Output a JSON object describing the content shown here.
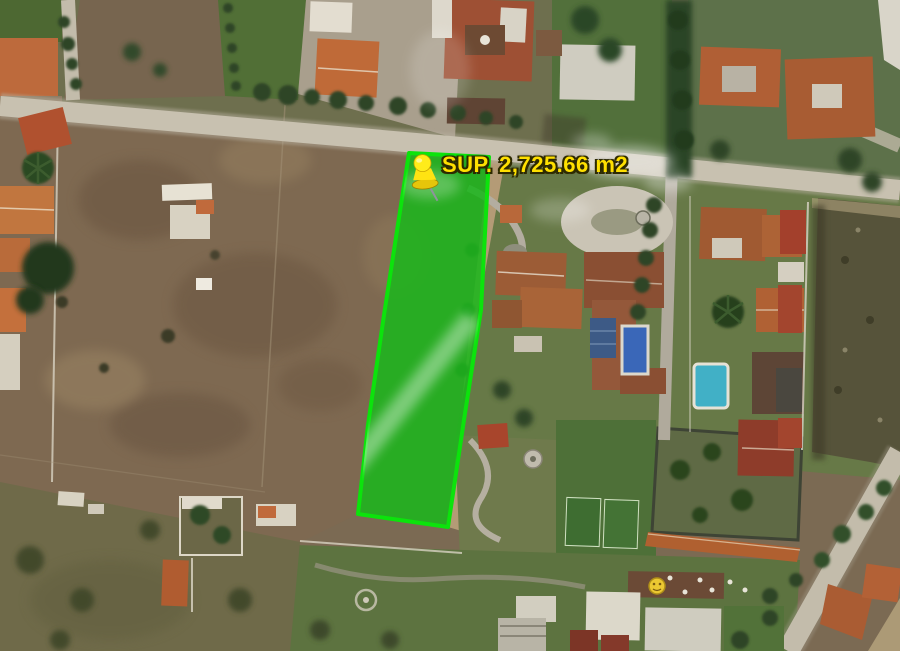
{
  "map": {
    "annotation": {
      "area_label": "SUP. 2,725.66 m2",
      "area_value": "2,725.66",
      "area_unit": "m2",
      "label_color": "#ffe000",
      "pin_icon": "pushpin-icon",
      "pin_color": "#ffe312"
    },
    "parcel": {
      "fill_color": "#1db51d",
      "border_color": "#0ce30c"
    },
    "palette": {
      "road": "#c8c1b0",
      "field_brown": "#7e6951",
      "scrub_olive": "#6f6a49",
      "lawn_green": "#5d7443",
      "tree_green": "#2e4526",
      "roof_orange": "#b05f35",
      "roof_red": "#9e5034",
      "pool_blue": "#3a67b8",
      "pool_cyan": "#41b0c6"
    }
  }
}
